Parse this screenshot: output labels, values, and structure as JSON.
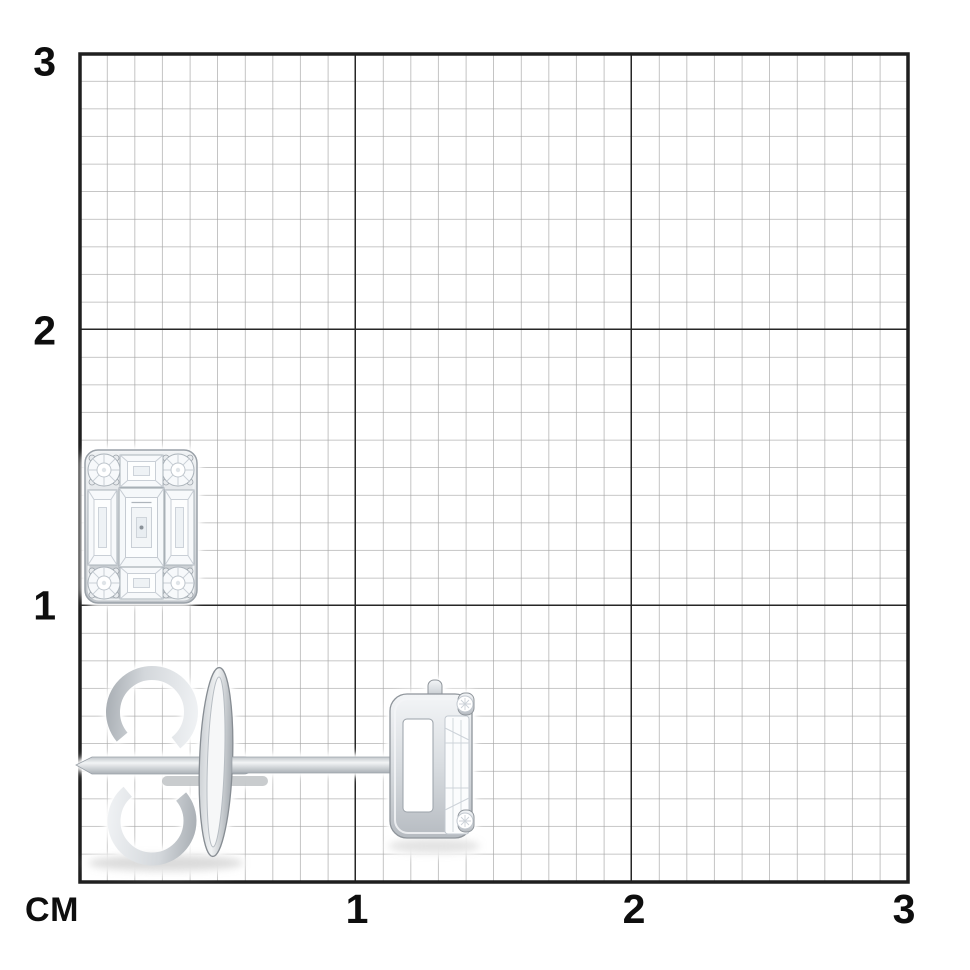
{
  "page": {
    "background_color": "#ffffff"
  },
  "ruler": {
    "unit_label": "СМ",
    "y_axis_labels": [
      "3",
      "2",
      "1"
    ],
    "x_axis_labels": [
      "1",
      "2",
      "3"
    ],
    "label_color": "#0e0e0e",
    "grid": {
      "minor_line_color": "#a4a4a4",
      "major_line_color": "#262626",
      "minor_cells_per_cm": 10,
      "span_cm": 3
    }
  },
  "photo": {
    "subject": "white-gold diamond stud earring shown on centimeter grid, front view and side view",
    "front_view": {
      "name": "stud-earring-front-view",
      "stones": "emerald-cut center, baguette sides, four corner round diamonds",
      "approx_width_cm": 0.4,
      "approx_height_cm": 0.55
    },
    "side_view": {
      "name": "stud-earring-side-view",
      "parts": [
        "butterfly-back",
        "ear-post",
        "basket-setting-with-prongs"
      ],
      "approx_length_cm": 1.4
    },
    "metal_highlight_color": "#f5f6f8",
    "metal_shadow_color": "#8f959b"
  }
}
